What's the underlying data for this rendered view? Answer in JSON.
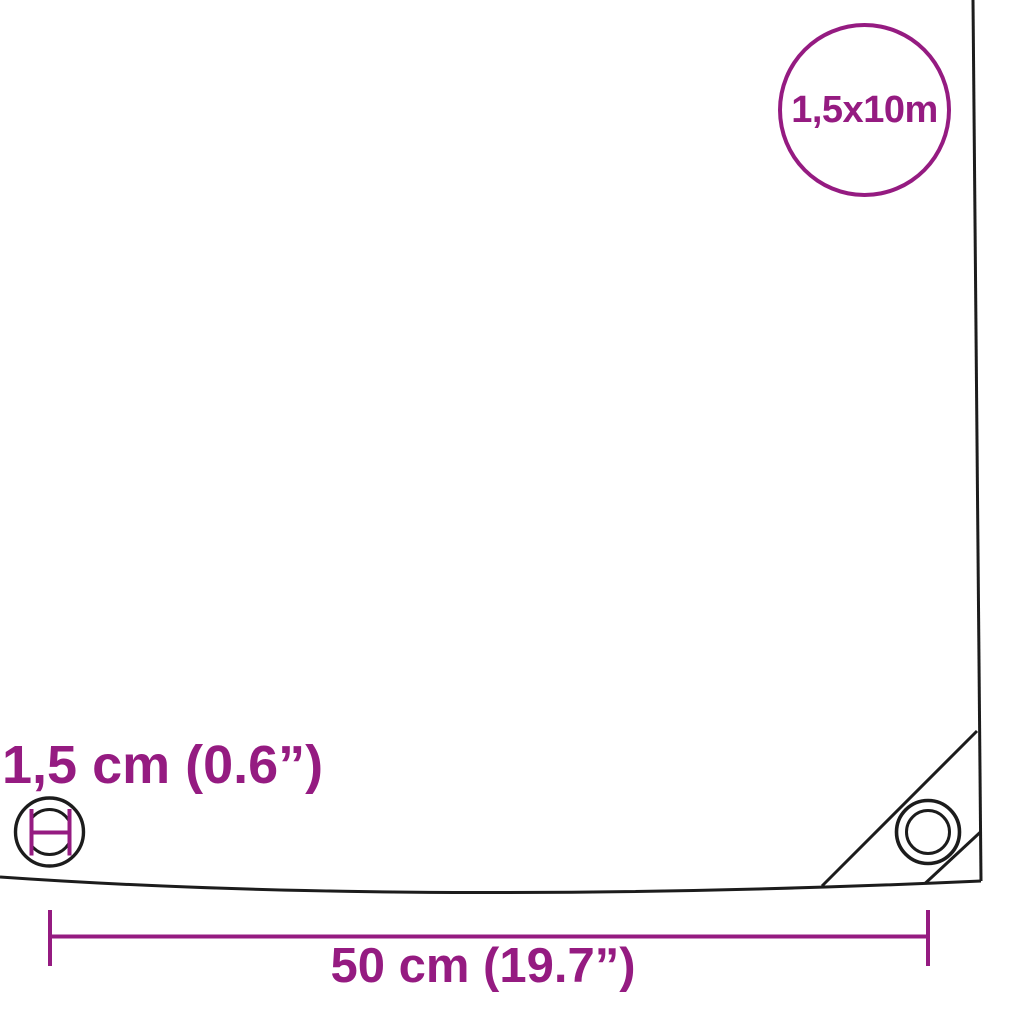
{
  "diagram": {
    "background_color": "#ffffff",
    "line_color": "#1c1c1c",
    "accent_color": "#951b81",
    "size_badge": {
      "label": "1,5x10m",
      "shape": "circle-outline"
    },
    "eyelet_diameter": {
      "label": "1,5 cm (0.6”)",
      "icon": "grommet-diameter-icon"
    },
    "eyelet_spacing": {
      "label": "50 cm (19.7”)",
      "style": "tick-ended-dimension-line"
    },
    "corner": {
      "icon": "corner-eyelet-icon",
      "features": [
        "reinforcement-seam",
        "chamfered-corner"
      ]
    }
  }
}
